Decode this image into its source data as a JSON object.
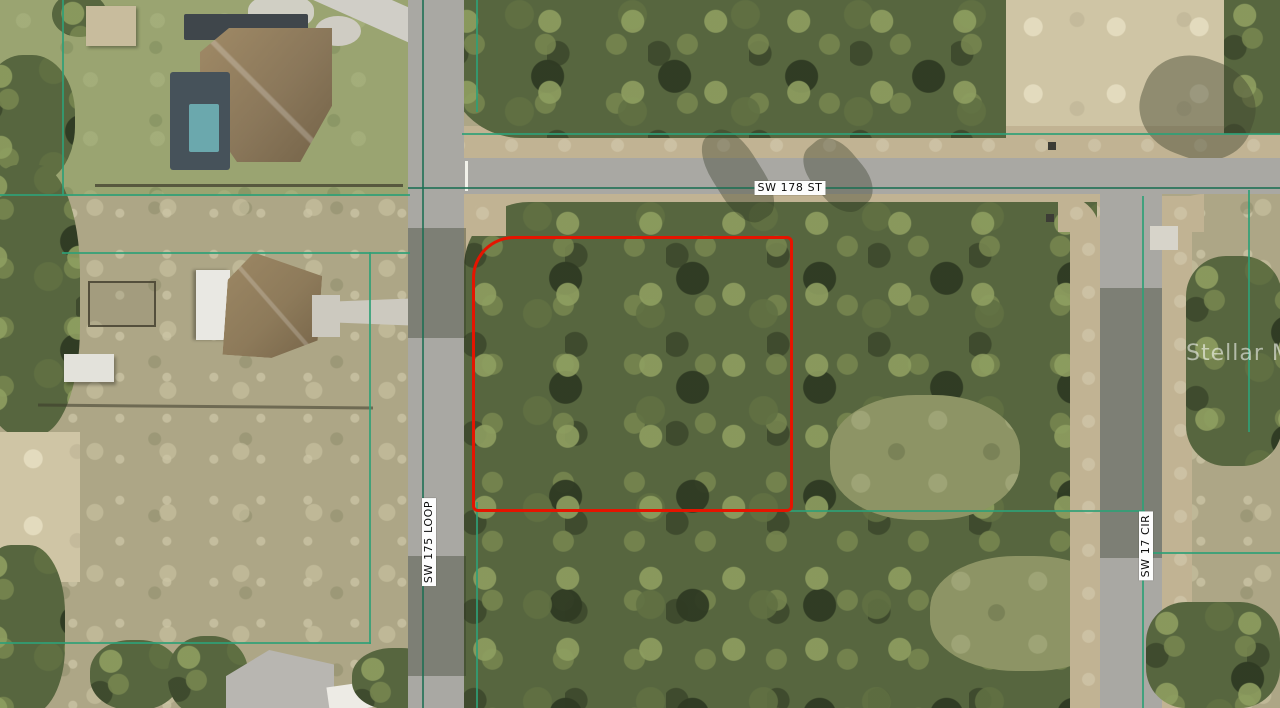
{
  "map": {
    "description": "Aerial photo of vacant wooded residential lot outlined in red",
    "watermark": "Stellar MLS",
    "streets": [
      {
        "name": "SW 178 ST",
        "orientation": "horizontal"
      },
      {
        "name": "SW 175 LOOP",
        "orientation": "vertical"
      },
      {
        "name": "SW 17 CIR",
        "orientation": "vertical"
      }
    ],
    "colors": {
      "parcel_highlight": "#e51400",
      "parcel_boundary_line": "#2fa077",
      "road": "#a9a8a3",
      "watermark_text": "#ffffff"
    }
  }
}
